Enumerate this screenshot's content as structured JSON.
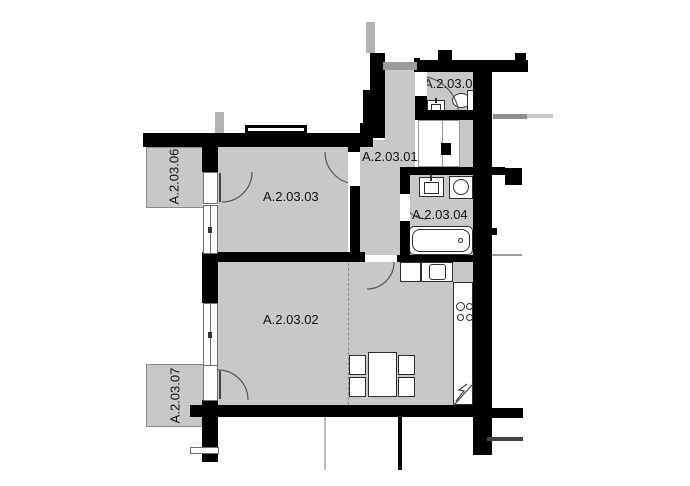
{
  "plan": {
    "title": "apartment-floor-plan",
    "rooms": [
      {
        "label": "A.2.03.01"
      },
      {
        "label": "A.2.03.02"
      },
      {
        "label": "A.2.03.03"
      },
      {
        "label": "A.2.03.04"
      },
      {
        "label": "A.2.03.05"
      },
      {
        "label": "A.2.03.06"
      },
      {
        "label": "A.2.03.07"
      }
    ],
    "fixtures": [
      "entrance-door",
      "toilet-icon",
      "wc-sink-icon",
      "bathroom-sink-icon",
      "washing-machine-icon",
      "bathtub-icon",
      "kitchen-counter",
      "kitchen-sink-icon",
      "cooktop-icon",
      "tall-kitchen-unit",
      "dining-table",
      "dining-chair-x4",
      "balcony-x2",
      "kitchen-divider-dashed-line",
      "door-swing-arc-x6",
      "window-x4"
    ],
    "colors": {
      "wall": "#000000",
      "room_floor": "#c8c8c8",
      "balcony_floor": "#c8c8c8",
      "fixture_outline": "#2e2e2e",
      "door_arc": "#555555",
      "entry_door": "#9b9b9b",
      "dashed_divider": "#8a8a8a",
      "exterior_gray": "#b3b3b3",
      "label_text": "#111111",
      "background": "#ffffff"
    }
  }
}
